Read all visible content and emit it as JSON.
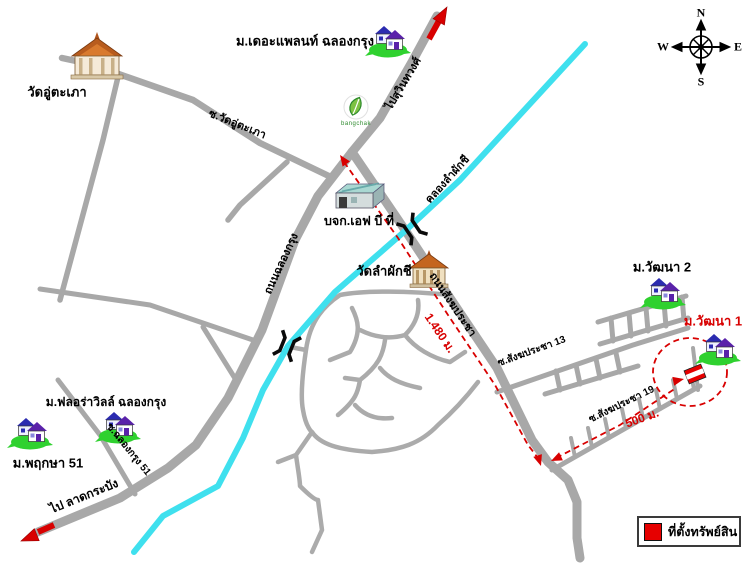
{
  "map": {
    "places": {
      "wat_u_taphao": "วัดอู่ตะเภา",
      "the_plant": "ม.เดอะแพลนท์ ฉลองกรุง",
      "bangchak": "bangchak",
      "fbt_company": "บจก.เอฟ บี ที่",
      "wat_lam_phak_chi": "วัดลำผักชี",
      "wattana2": "ม.วัฒนา 2",
      "wattana1": "ม.วัฒนา 1",
      "floraville": "ม.ฟลอร่าวิลล์ ฉลองกรุง",
      "pruksa51": "ม.พฤกษา 51"
    },
    "roads": {
      "to_suwinthawong": "ไปสุวินทวงศ์",
      "soi_wat_u_taphao": "ซ.วัดอู่ตะเภา",
      "chalong_krung": "ถนนฉลองกรุง",
      "sangkhapracha": "ถนนสังฆประชา",
      "soi_sangkhapracha_13": "ซ.สังฆประชา 13",
      "soi_sangkhapracha_19": "ซ.สังฆประชา 19",
      "soi_chalong_krung_51": "ซ.ฉลองกรุง 51",
      "to_lat_krabang": "ไป ลาดกระบัง",
      "khlong_lam_phak_chi": "คลองลำผักชี"
    },
    "distances": {
      "route_main": "1.480 ม.",
      "route_soi": "500 ม."
    },
    "compass": {
      "n": "N",
      "e": "E",
      "s": "S",
      "w": "W"
    },
    "legend": {
      "property_location": "ที่ตั้งทรัพย์สิน"
    },
    "colors": {
      "road": "#a8a8a8",
      "canal": "#3fe0ee",
      "accent_red": "#e00000",
      "estate_green": "#2fd12f"
    }
  }
}
